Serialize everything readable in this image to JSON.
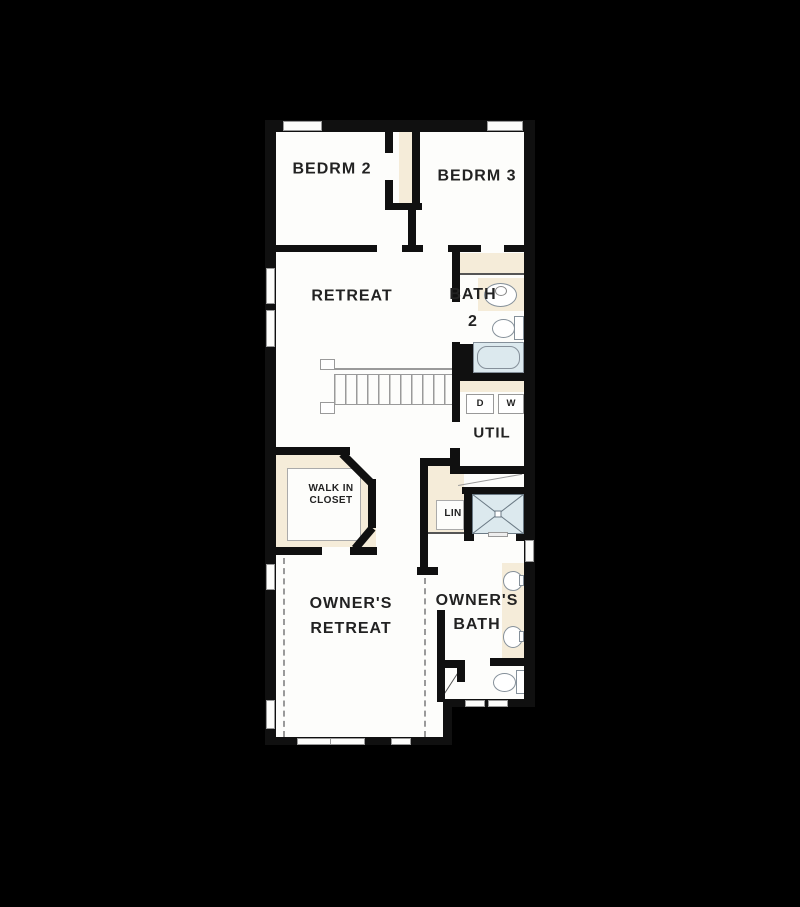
{
  "rooms": {
    "bedroom2": {
      "label": "BEDRM 2"
    },
    "bedroom3": {
      "label": "BEDRM 3"
    },
    "retreat": {
      "label": "RETREAT"
    },
    "bath2": {
      "line1": "BATH",
      "line2": "2"
    },
    "utility": {
      "label": "UTIL"
    },
    "walk_in_closet": {
      "line1": "WALK IN",
      "line2": "CLOSET"
    },
    "linen_closet": {
      "label": "LIN"
    },
    "owners_retreat": {
      "line1": "OWNER'S",
      "line2": "RETREAT"
    },
    "owners_bath": {
      "line1": "OWNER'S",
      "line2": "BATH"
    }
  },
  "appliances": {
    "dryer_label": "D",
    "washer_label": "W"
  },
  "fixtures": [
    "stairs-icon",
    "bathtub-icon",
    "toilet-icon",
    "sink-icon",
    "shower-icon",
    "washer-icon",
    "dryer-icon",
    "window-icon",
    "tray-ceiling-dashed-line"
  ],
  "colors": {
    "background": "#000000",
    "floor": "#fdfdfb",
    "wall": "#101010",
    "closet_fill": "#f5ecd9",
    "fixture_blue": "#dce9ee",
    "line_gray": "#9a9a9a",
    "text": "#222222"
  }
}
